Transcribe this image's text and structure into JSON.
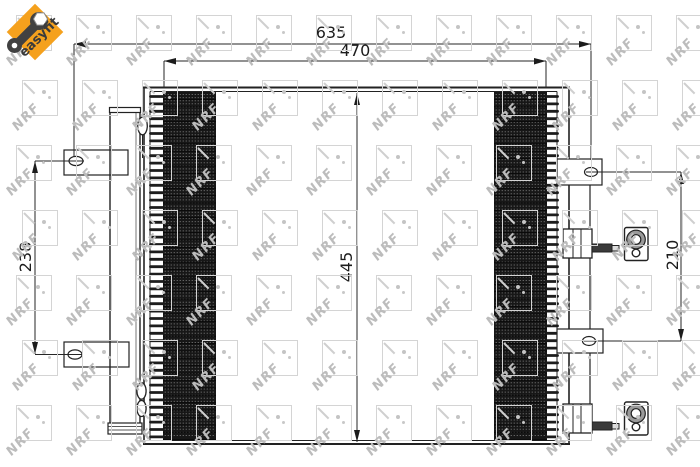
{
  "badge": {
    "label": "easyfit"
  },
  "watermark": {
    "brand": "NRF"
  },
  "drawing": {
    "dimensions": {
      "total_width_mm": "635",
      "core_width_mm": "470",
      "core_height_mm": "445",
      "left_bracket_pitch_mm": "238",
      "right_bracket_pitch_mm": "210"
    }
  },
  "colors": {
    "badge_orange": "#f5a11d",
    "line_dark": "#1e1e1e",
    "band_fill": "#171717",
    "watermark_gray": "#bcbcbc"
  }
}
